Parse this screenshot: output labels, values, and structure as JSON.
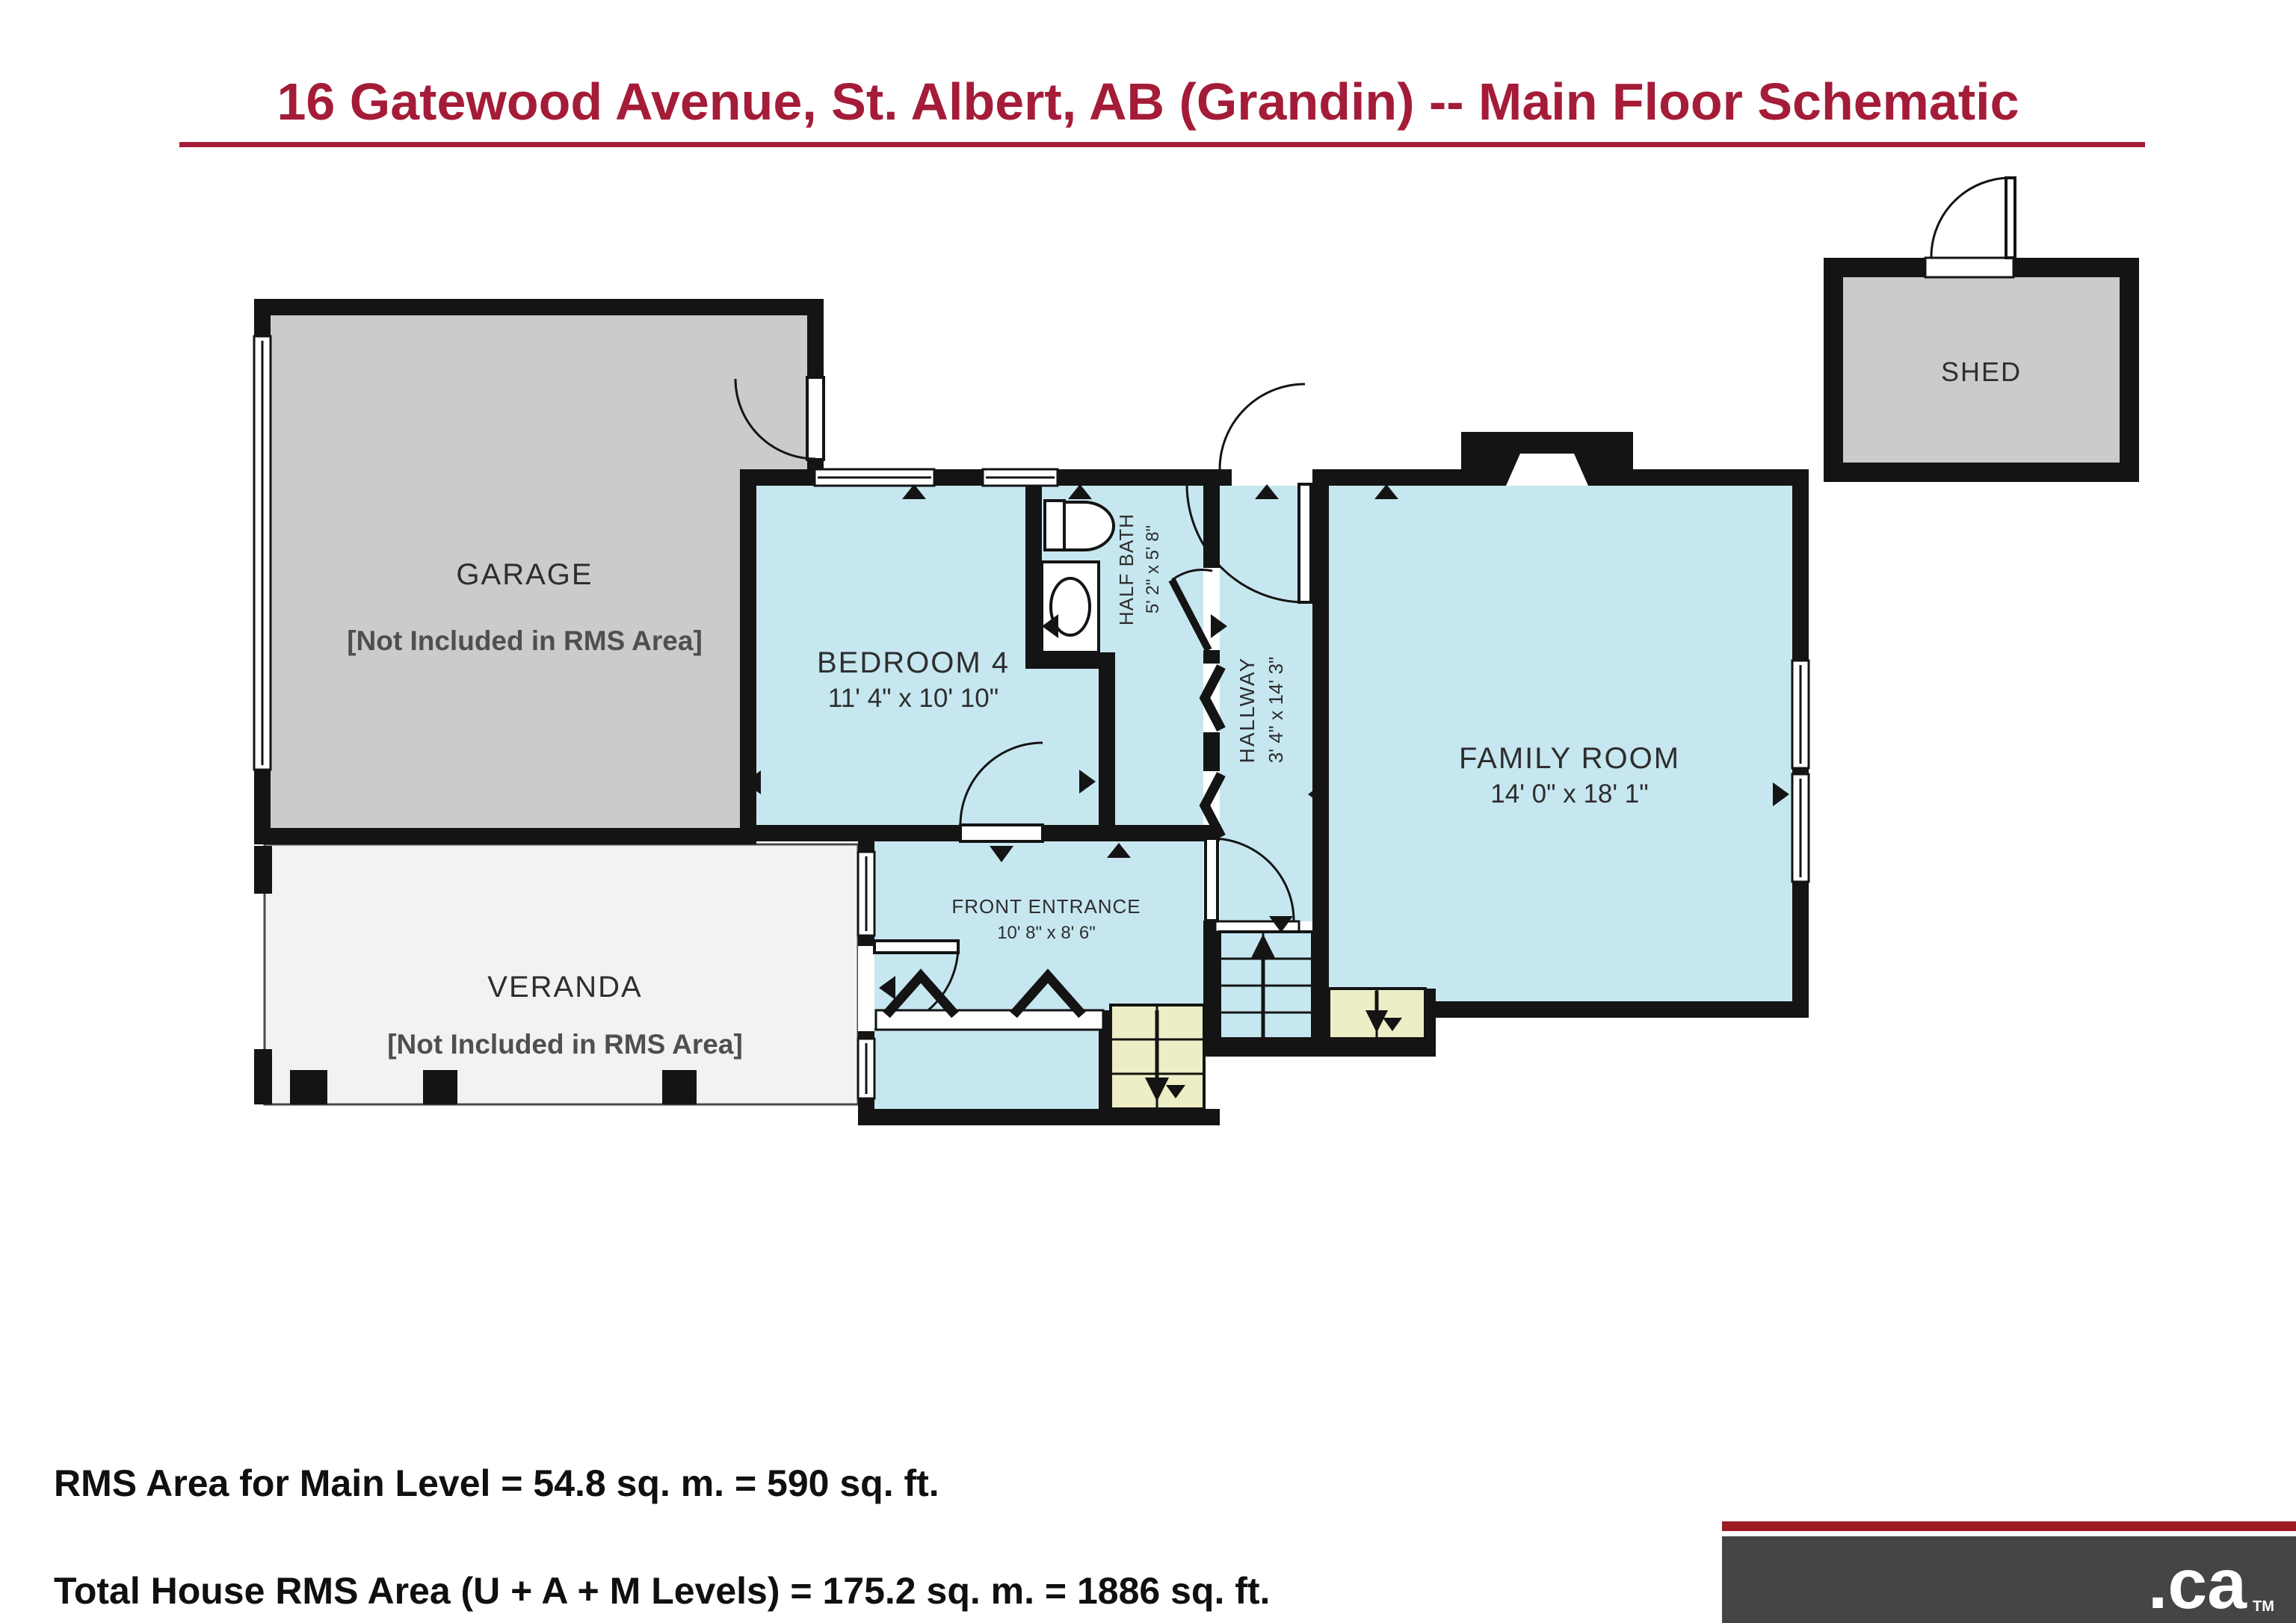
{
  "title": {
    "text": "16 Gatewood Avenue, St. Albert, AB (Grandin) -- Main Floor Schematic"
  },
  "plan": {
    "garage": {
      "name": "GARAGE",
      "note": "[Not Included in RMS Area]"
    },
    "bedroom4": {
      "name": "BEDROOM 4",
      "dims": "11' 4\" x 10' 10\""
    },
    "half_bath": {
      "name": "HALF BATH",
      "dims": "5' 2\" x 5' 8\""
    },
    "hallway": {
      "name": "HALLWAY",
      "dims": "3' 4\" x 14' 3\""
    },
    "family_room": {
      "name": "FAMILY ROOM",
      "dims": "14' 0\" x 18' 1\""
    },
    "front_entrance": {
      "name": "FRONT ENTRANCE",
      "dims": "10' 8\" x 8' 6\""
    },
    "veranda": {
      "name": "VERANDA",
      "note": "[Not Included in RMS Area]"
    },
    "shed": {
      "name": "SHED"
    }
  },
  "annotations": {
    "main_level": "RMS Area for Main Level = 54.8 sq. m. = 590 sq. ft.",
    "total_house": "Total House RMS Area (U + A + M Levels) = 175.2 sq. m. = 1886 sq. ft."
  },
  "logo": {
    "text": ".ca",
    "tm": "TM"
  },
  "colors": {
    "title": "#a41c38",
    "walls": "#141414",
    "room_fill": "#c6e7f0",
    "stair_fill": "#eeeec6",
    "garage_fill": "#cbcbca",
    "veranda_fill": "#f2f2f1",
    "label": "#2e2e2e",
    "note": "#4f4f4f",
    "logo_bar": "#9e1b24",
    "logo_bg": "#454545"
  }
}
